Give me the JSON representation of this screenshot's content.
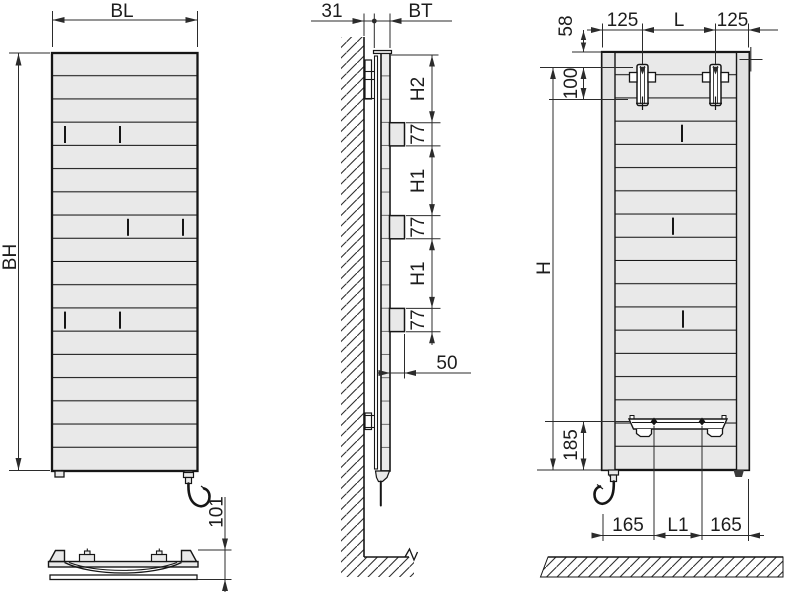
{
  "labels": {
    "front": {
      "bl": "BL",
      "bh": "BH",
      "d101": "101"
    },
    "side": {
      "d31": "31",
      "bt": "BT",
      "h2": "H2",
      "s77a": "77",
      "h1a": "H1",
      "s77b": "77",
      "h1b": "H1",
      "s77c": "77",
      "d50": "50"
    },
    "rear": {
      "d58": "58",
      "d125l": "125",
      "l": "L",
      "d125r": "125",
      "d100": "100",
      "h": "H",
      "d185": "185",
      "d165l": "165",
      "l1": "L1",
      "d165r": "165"
    }
  },
  "colors": {
    "background": "#ffffff",
    "panel_fill": "#e9e9e9",
    "side_strip_fill": "#e2e2e2",
    "line": "#161616",
    "dimension": "#2b2b2b"
  }
}
